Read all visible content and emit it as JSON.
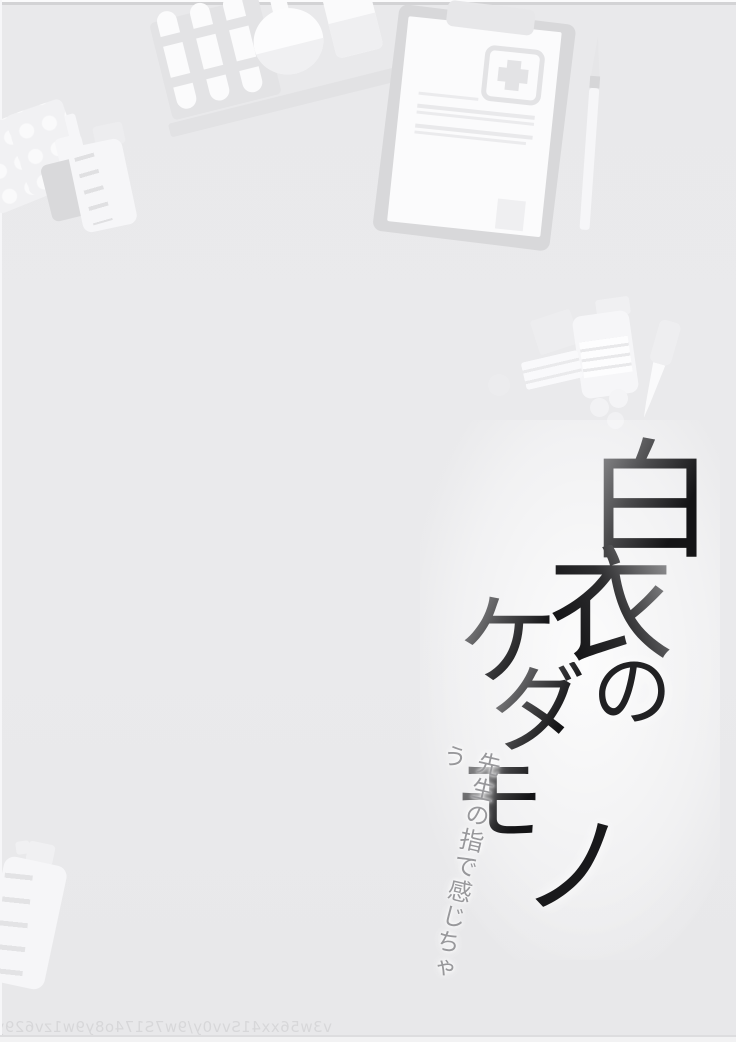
{
  "page": {
    "background_color": "#eaeaec",
    "type_label": "manga title page"
  },
  "title": {
    "text": "白衣のケダモノ",
    "chars": [
      "白",
      "衣",
      "の",
      "ケ",
      "ダ",
      "モ",
      "ノ"
    ],
    "color_dark": "#1b1b1d",
    "color_gray": "#8e8e90"
  },
  "subtitle": {
    "text": "先生の指で感じちゃう",
    "color": "#98989b"
  },
  "watermark": {
    "text": "v3w56xx41Svv0y/9w7S174o8y9w1zv629y",
    "mirrored": true,
    "color": "#d7d7d9"
  },
  "illustrations": {
    "tone_light": "#f6f6f8",
    "tone_shadow": "#d9d9db",
    "items": [
      "blister-pack",
      "blister-pack",
      "nasal-spray-bottle",
      "graduated-medicine-bottle",
      "test-tube-rack",
      "test-tubes",
      "round-flask",
      "beaker",
      "graduated-cylinder",
      "tray-rail",
      "clipboard",
      "medical-cross",
      "paper-text-lines",
      "pen",
      "medicine-box",
      "pill-bottle",
      "label-card",
      "pills",
      "dropper-vial",
      "medicine-bottle-bottom-left"
    ]
  }
}
